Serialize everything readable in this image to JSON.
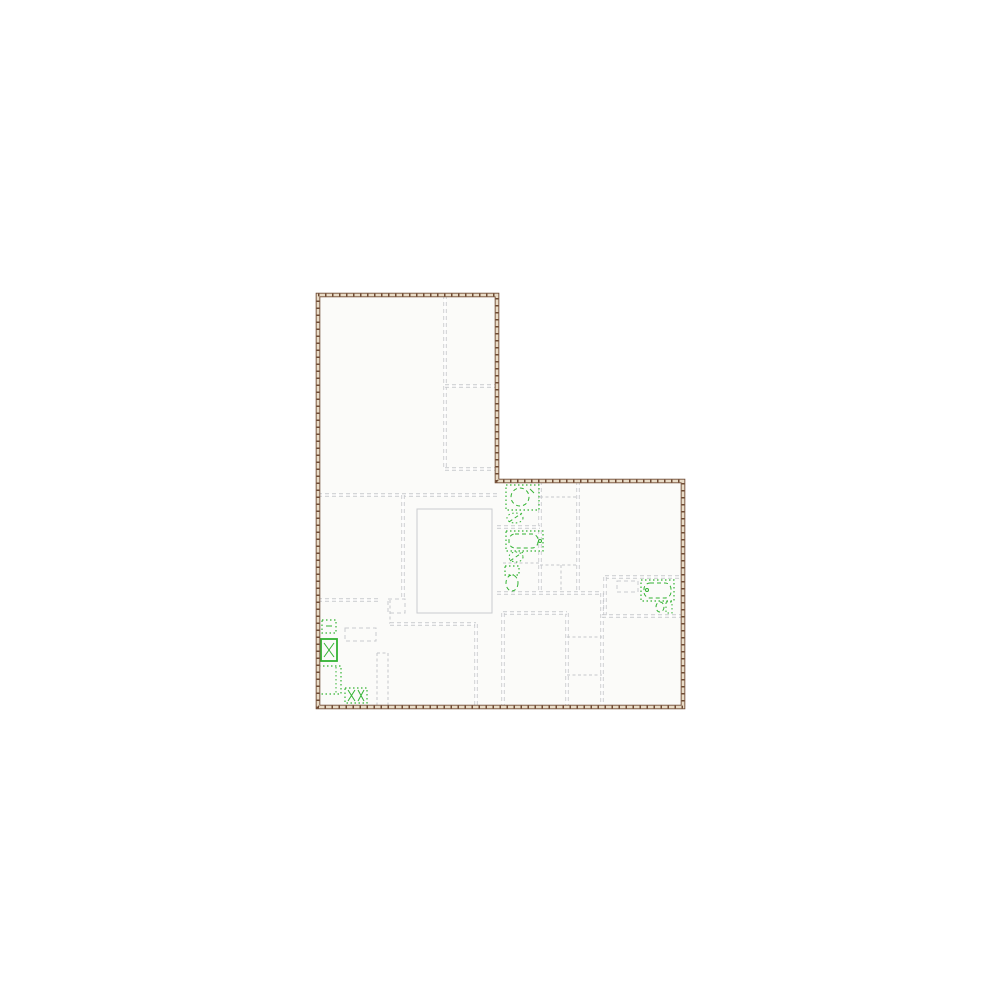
{
  "plan": {
    "canvas": {
      "width": 1000,
      "height": 1000,
      "background": "#ffffff"
    },
    "colors": {
      "floor_fill": "#fbfbf9",
      "outer_wall_dark": "#6e4a33",
      "outer_wall_light": "#e9dcc7",
      "interior_wall": "#c8cacd",
      "interior_wall_core": "#ffffff",
      "thin_wall": "#c5c7ca",
      "furniture_gray": "#c9cbce",
      "fixture_green": "#33b333"
    },
    "boundary": {
      "points": [
        [
          318,
          295
        ],
        [
          497,
          295
        ],
        [
          497,
          481
        ],
        [
          683,
          481
        ],
        [
          683,
          707
        ],
        [
          318,
          707
        ]
      ]
    },
    "walls": [
      {
        "x1": 445,
        "y1": 295,
        "x2": 445,
        "y2": 470,
        "style": "double"
      },
      {
        "x1": 445,
        "y1": 386,
        "x2": 497,
        "y2": 386,
        "style": "double"
      },
      {
        "x1": 445,
        "y1": 469,
        "x2": 497,
        "y2": 469,
        "style": "double"
      },
      {
        "x1": 318,
        "y1": 495,
        "x2": 497,
        "y2": 495,
        "style": "double"
      },
      {
        "x1": 403,
        "y1": 495,
        "x2": 403,
        "y2": 600,
        "style": "double"
      },
      {
        "x1": 318,
        "y1": 600,
        "x2": 378,
        "y2": 600,
        "style": "double"
      },
      {
        "x1": 390,
        "y1": 600,
        "x2": 390,
        "y2": 624,
        "style": "thin"
      },
      {
        "x1": 390,
        "y1": 624,
        "x2": 476,
        "y2": 624,
        "style": "double"
      },
      {
        "x1": 476,
        "y1": 624,
        "x2": 476,
        "y2": 707,
        "style": "double"
      },
      {
        "x1": 377,
        "y1": 653,
        "x2": 377,
        "y2": 707,
        "style": "thin"
      },
      {
        "x1": 388,
        "y1": 653,
        "x2": 388,
        "y2": 707,
        "style": "thin"
      },
      {
        "x1": 377,
        "y1": 653,
        "x2": 388,
        "y2": 653,
        "style": "thin"
      },
      {
        "x1": 540,
        "y1": 481,
        "x2": 540,
        "y2": 593,
        "style": "double"
      },
      {
        "x1": 497,
        "y1": 527,
        "x2": 540,
        "y2": 527,
        "style": "double"
      },
      {
        "x1": 503,
        "y1": 563,
        "x2": 540,
        "y2": 563,
        "style": "thin"
      },
      {
        "x1": 540,
        "y1": 497,
        "x2": 578,
        "y2": 497,
        "style": "thin"
      },
      {
        "x1": 578,
        "y1": 481,
        "x2": 578,
        "y2": 593,
        "style": "double"
      },
      {
        "x1": 540,
        "y1": 565,
        "x2": 578,
        "y2": 565,
        "style": "thin"
      },
      {
        "x1": 561,
        "y1": 565,
        "x2": 561,
        "y2": 593,
        "style": "thin"
      },
      {
        "x1": 497,
        "y1": 593,
        "x2": 602,
        "y2": 593,
        "style": "double"
      },
      {
        "x1": 602,
        "y1": 593,
        "x2": 602,
        "y2": 707,
        "style": "double"
      },
      {
        "x1": 605,
        "y1": 577,
        "x2": 683,
        "y2": 577,
        "style": "double"
      },
      {
        "x1": 605,
        "y1": 577,
        "x2": 605,
        "y2": 616,
        "style": "double"
      },
      {
        "x1": 602,
        "y1": 616,
        "x2": 683,
        "y2": 616,
        "style": "double"
      },
      {
        "x1": 567,
        "y1": 613,
        "x2": 567,
        "y2": 707,
        "style": "double"
      },
      {
        "x1": 503,
        "y1": 613,
        "x2": 567,
        "y2": 613,
        "style": "double"
      },
      {
        "x1": 503,
        "y1": 613,
        "x2": 503,
        "y2": 707,
        "style": "double"
      },
      {
        "x1": 567,
        "y1": 637,
        "x2": 602,
        "y2": 637,
        "style": "thin"
      },
      {
        "x1": 567,
        "y1": 675,
        "x2": 602,
        "y2": 675,
        "style": "thin"
      }
    ],
    "gray_shapes": [
      {
        "name": "stairwell-outline",
        "shape": "rect",
        "x": 417,
        "y": 509,
        "w": 75,
        "h": 104,
        "dash": "solid"
      },
      {
        "name": "kitchen-island",
        "shape": "rect",
        "x": 345,
        "y": 628,
        "w": 31,
        "h": 13,
        "dash": "dash"
      },
      {
        "name": "utility-counter",
        "shape": "rect",
        "x": 617,
        "y": 581,
        "w": 21,
        "h": 11,
        "dash": "dash"
      },
      {
        "name": "hall-closet",
        "shape": "rect",
        "x": 388,
        "y": 599,
        "w": 17,
        "h": 14,
        "dash": "dash"
      }
    ],
    "fixtures": [
      {
        "name": "shower-stall",
        "parts": [
          {
            "shape": "rect",
            "x": 506,
            "y": 485,
            "w": 33,
            "h": 25,
            "dash": "dot",
            "w2": 1.2
          },
          {
            "shape": "circle",
            "cx": 520,
            "cy": 497,
            "r": 9,
            "dash": "dash",
            "w2": 1
          },
          {
            "shape": "line",
            "x1": 530,
            "y1": 489,
            "x2": 534,
            "y2": 493,
            "dash": "solid",
            "w2": 1
          }
        ]
      },
      {
        "name": "bathroom-sink-upper",
        "parts": [
          {
            "shape": "ellipse",
            "cx": 515,
            "cy": 518,
            "rx": 8,
            "ry": 5,
            "dash": "dot",
            "w2": 1
          },
          {
            "shape": "line",
            "x1": 509,
            "y1": 522,
            "x2": 522,
            "y2": 513,
            "dash": "dash",
            "w2": 1
          }
        ]
      },
      {
        "name": "bathtub",
        "parts": [
          {
            "shape": "rect",
            "x": 506,
            "y": 531,
            "w": 37,
            "h": 20,
            "dash": "dot",
            "w2": 1.2
          },
          {
            "shape": "rect",
            "x": 509,
            "y": 534,
            "w": 29,
            "h": 14,
            "rx": 6,
            "dash": "dash",
            "w2": 1
          },
          {
            "shape": "circle",
            "cx": 540,
            "cy": 541,
            "r": 1.5,
            "dash": "solid",
            "w2": 1
          }
        ]
      },
      {
        "name": "bathroom-sink-lower",
        "parts": [
          {
            "shape": "ellipse",
            "cx": 516,
            "cy": 557,
            "rx": 7,
            "ry": 5,
            "dash": "dot",
            "w2": 1
          },
          {
            "shape": "line",
            "x1": 510,
            "y1": 561,
            "x2": 523,
            "y2": 552,
            "dash": "dash",
            "w2": 1
          }
        ]
      },
      {
        "name": "toilet",
        "parts": [
          {
            "shape": "rect",
            "x": 505,
            "y": 566,
            "w": 14,
            "h": 9,
            "dash": "dot",
            "w2": 1.2
          },
          {
            "shape": "ellipse",
            "cx": 512,
            "cy": 583,
            "rx": 6,
            "ry": 8,
            "dash": "dash",
            "w2": 1
          }
        ]
      },
      {
        "name": "washing-machine",
        "parts": [
          {
            "shape": "rect",
            "x": 641,
            "y": 580,
            "w": 33,
            "h": 21,
            "dash": "dot",
            "w2": 1.2
          },
          {
            "shape": "rect",
            "x": 644,
            "y": 583,
            "w": 27,
            "h": 15,
            "rx": 6,
            "dash": "dash",
            "w2": 1
          },
          {
            "shape": "circle",
            "cx": 647,
            "cy": 590,
            "r": 1.5,
            "dash": "solid",
            "w2": 1
          }
        ]
      },
      {
        "name": "toilet-side-view",
        "parts": [
          {
            "shape": "ellipse",
            "cx": 660,
            "cy": 607,
            "rx": 4,
            "ry": 5,
            "dash": "dash",
            "w2": 1
          },
          {
            "shape": "rect",
            "x": 666,
            "y": 602,
            "w": 6,
            "h": 11,
            "dash": "dot",
            "w2": 1
          }
        ]
      },
      {
        "name": "kitchen-sink",
        "parts": [
          {
            "shape": "rect",
            "x": 322,
            "y": 620,
            "w": 14,
            "h": 13,
            "dash": "dot",
            "w2": 1.2
          },
          {
            "shape": "line",
            "x1": 326,
            "y1": 626,
            "x2": 332,
            "y2": 626,
            "dash": "solid",
            "w2": 1
          }
        ]
      },
      {
        "name": "stove",
        "parts": [
          {
            "shape": "rect",
            "x": 321,
            "y": 639,
            "w": 16,
            "h": 22,
            "dash": "solid",
            "w2": 1.8
          },
          {
            "shape": "line",
            "x1": 324,
            "y1": 643,
            "x2": 334,
            "y2": 657,
            "dash": "solid",
            "w2": 1
          },
          {
            "shape": "line",
            "x1": 334,
            "y1": 643,
            "x2": 324,
            "y2": 657,
            "dash": "solid",
            "w2": 1
          }
        ]
      },
      {
        "name": "refrigerator",
        "parts": [
          {
            "shape": "rect",
            "x": 319,
            "y": 666,
            "w": 22,
            "h": 28,
            "dash": "dot",
            "w2": 1.2
          },
          {
            "shape": "line",
            "x1": 336,
            "y1": 667,
            "x2": 336,
            "y2": 693,
            "dash": "dot",
            "w2": 1
          }
        ]
      },
      {
        "name": "dishwasher",
        "parts": [
          {
            "shape": "rect",
            "x": 345,
            "y": 688,
            "w": 22,
            "h": 15,
            "dash": "dot",
            "w2": 1.2
          },
          {
            "shape": "line",
            "x1": 348,
            "y1": 690,
            "x2": 355,
            "y2": 701,
            "dash": "solid",
            "w2": 1
          },
          {
            "shape": "line",
            "x1": 355,
            "y1": 690,
            "x2": 348,
            "y2": 701,
            "dash": "solid",
            "w2": 1
          },
          {
            "shape": "line",
            "x1": 358,
            "y1": 690,
            "x2": 364,
            "y2": 701,
            "dash": "solid",
            "w2": 1
          },
          {
            "shape": "line",
            "x1": 364,
            "y1": 690,
            "x2": 358,
            "y2": 701,
            "dash": "solid",
            "w2": 1
          }
        ]
      }
    ]
  }
}
